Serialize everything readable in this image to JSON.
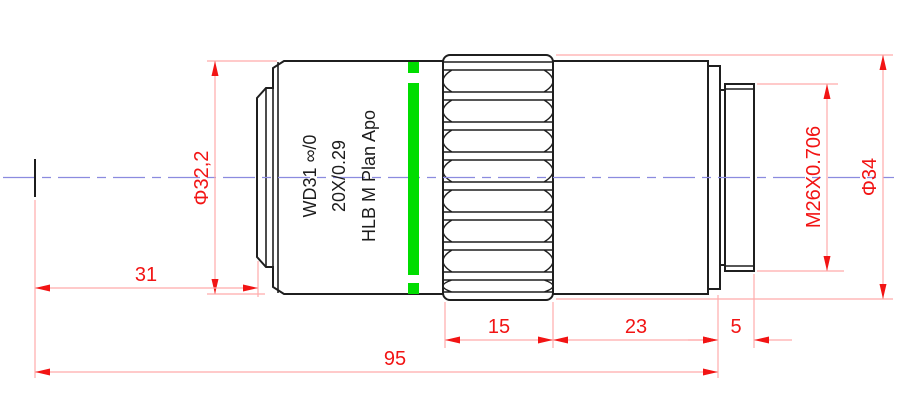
{
  "drawing": {
    "kind": "technical-dimension-drawing",
    "subject": "microscope-objective-lens-side-view",
    "engraving": {
      "line1": "HLB M Plan Apo",
      "line2": "20X/0.29",
      "line3": "WD31 ∞/0"
    },
    "dimensions": {
      "front_body_diameter": "Φ32,2",
      "front_distance": "31",
      "knurl_length": "15",
      "rear_body_length": "23",
      "thread_length": "5",
      "overall_length": "95",
      "mount_thread": "M26X0.706",
      "outer_diameter": "Φ34"
    },
    "colors": {
      "dimension_accent": "#f21414",
      "dimension_line": "#ffabab",
      "outline": "#1f1f1f",
      "centerline": "#8b8bdf",
      "band_green": "#00dd00",
      "background": "#ffffff"
    }
  }
}
